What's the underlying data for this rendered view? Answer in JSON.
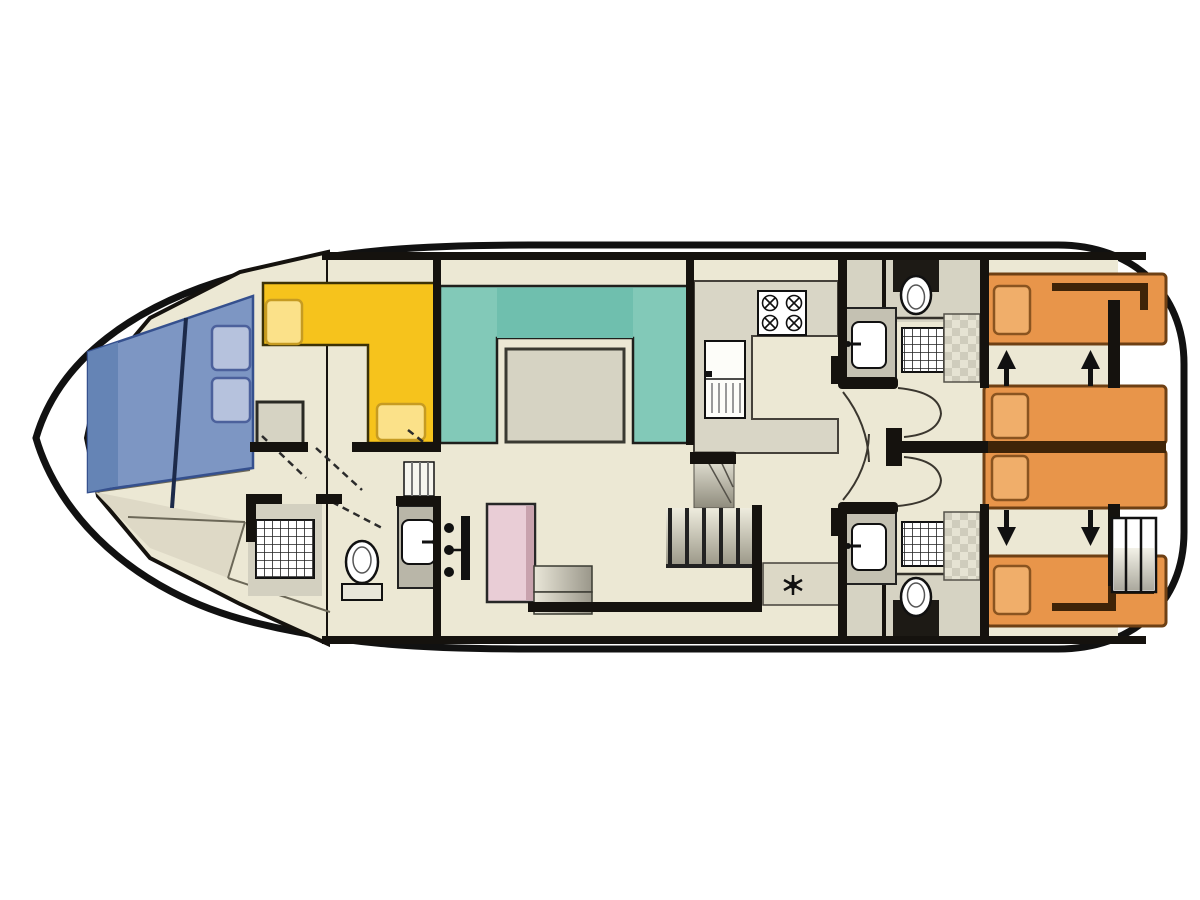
{
  "diagram": {
    "title": "Houseboat deck floor plan",
    "type": "floor-plan",
    "orientation": "bow-left, stern-right"
  },
  "palette": {
    "page_bg": "#ffffff",
    "hull_line": "#111111",
    "deck_white": "#ffffff",
    "floor": "#ece8d4",
    "floor_shade": "#dcd8c6",
    "wall": "#15120e",
    "counter_gray": "#d9d6c6",
    "tile_light": "#e6e3d3",
    "tile_dark": "#cfccbc",
    "berth_blue": "#7d96c3",
    "berth_blue_dark": "#6584b5",
    "pillow_blue": "#b6c2dd",
    "dinette_yellow": "#f6c31c",
    "cushion_yellow": "#fbe189",
    "sofa_teal": "#82c9b8",
    "sofa_teal_dark": "#6fbfae",
    "table_gray": "#d6d3c3",
    "wardrobe_pink": "#e9cdd6",
    "wardrobe_pink_dark": "#c8a2ad",
    "bed_orange": "#e8954a",
    "bed_orange_border": "#6e4014",
    "pillow_orange": "#f0ae6a",
    "bed_trim_brown": "#3f2408",
    "stair_light": "#efede0",
    "stair_dark": "#8f8c7d",
    "fixture_white": "#ffffff",
    "arrow_black": "#111111"
  },
  "labels": {
    "hull": "boat hull outline",
    "bow_berth": "bow berth with two pillows",
    "bow_floor": "bow cabin floor",
    "dinette": "front cabin L-shaped dinette",
    "dinette_table": "front cabin side table",
    "bathroom_front": "front bathroom with shower, toilet and washbasin",
    "saloon": "saloon U-shaped sofa",
    "saloon_table": "saloon table",
    "galley": "galley with stove, fridge and worktop",
    "stove": "four burner stove",
    "fridge": "refrigerator",
    "wardrobe": "wardrobe cabinet",
    "steps": "corridor steps",
    "stairs": "companionway stairs with railing",
    "corridor_aft": "aft corridor",
    "heater": "heater asterisk symbol",
    "bathroom_top": "aft bathroom (top) with washbasin, shower and toilet",
    "bathroom_bottom": "aft bathroom (bottom) with washbasin, shower and toilet",
    "bed_single_top": "aft single berth (top)",
    "bed_double_upper": "sliding berth (upper middle)",
    "bed_double_lower": "sliding berth (lower middle)",
    "bed_single_bottom": "aft single berth (bottom)",
    "slide_arrows": "berth sliding direction arrows",
    "ladder": "stern ladder steps",
    "doors": "door swing marks"
  }
}
